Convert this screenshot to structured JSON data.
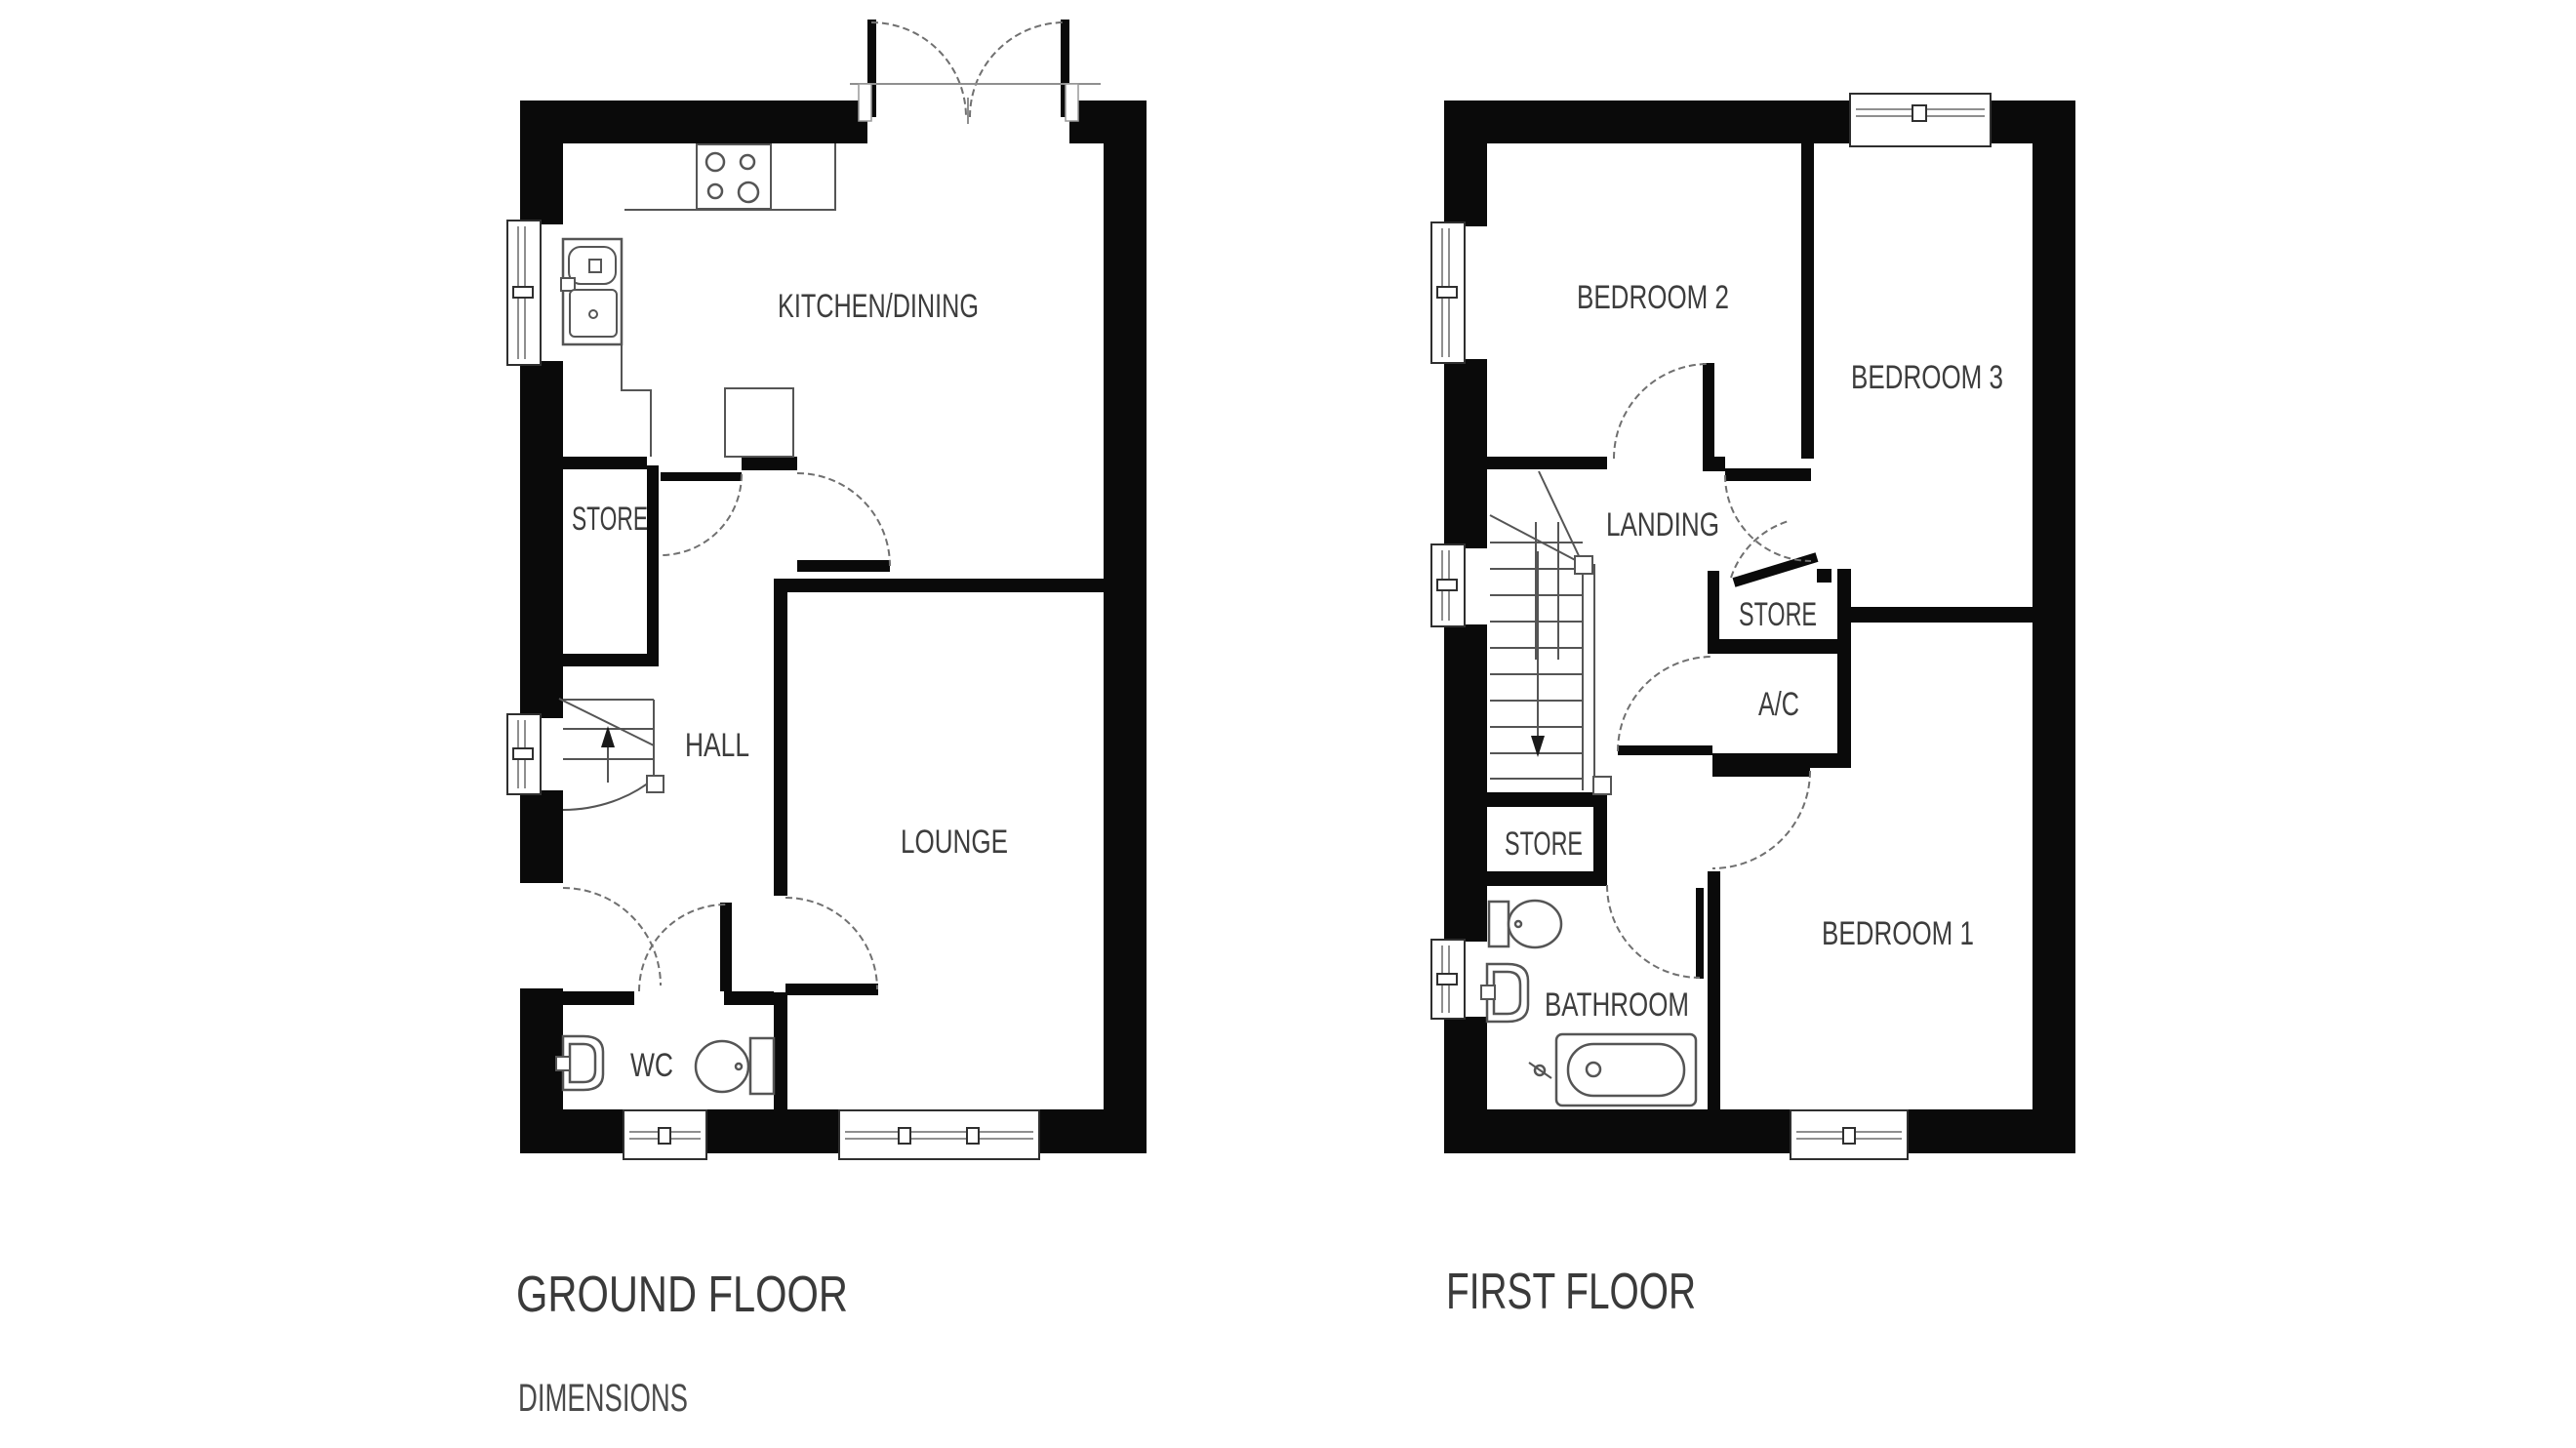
{
  "colors": {
    "wall": "#0a0a0a",
    "line": "#555555",
    "arc": "#707070",
    "window_frame": "#2f2f2f",
    "window_glass": "#8f8f8f",
    "text": "#3d3d3d",
    "title_text": "#3a3a3a",
    "caption_text": "#4a4a4a"
  },
  "ground_floor": {
    "title": "GROUND FLOOR",
    "rooms": {
      "kitchen_dining": "KITCHEN/DINING",
      "store": "STORE",
      "hall": "HALL",
      "lounge": "LOUNGE",
      "wc": "WC"
    }
  },
  "first_floor": {
    "title": "FIRST FLOOR",
    "rooms": {
      "bedroom2": "BEDROOM 2",
      "bedroom3": "BEDROOM 3",
      "landing": "LANDING",
      "store_upper": "STORE",
      "ac": "A/C",
      "store_lower": "STORE",
      "bathroom": "BATHROOM",
      "bedroom1": "BEDROOM 1"
    }
  },
  "caption": "DIMENSIONS"
}
